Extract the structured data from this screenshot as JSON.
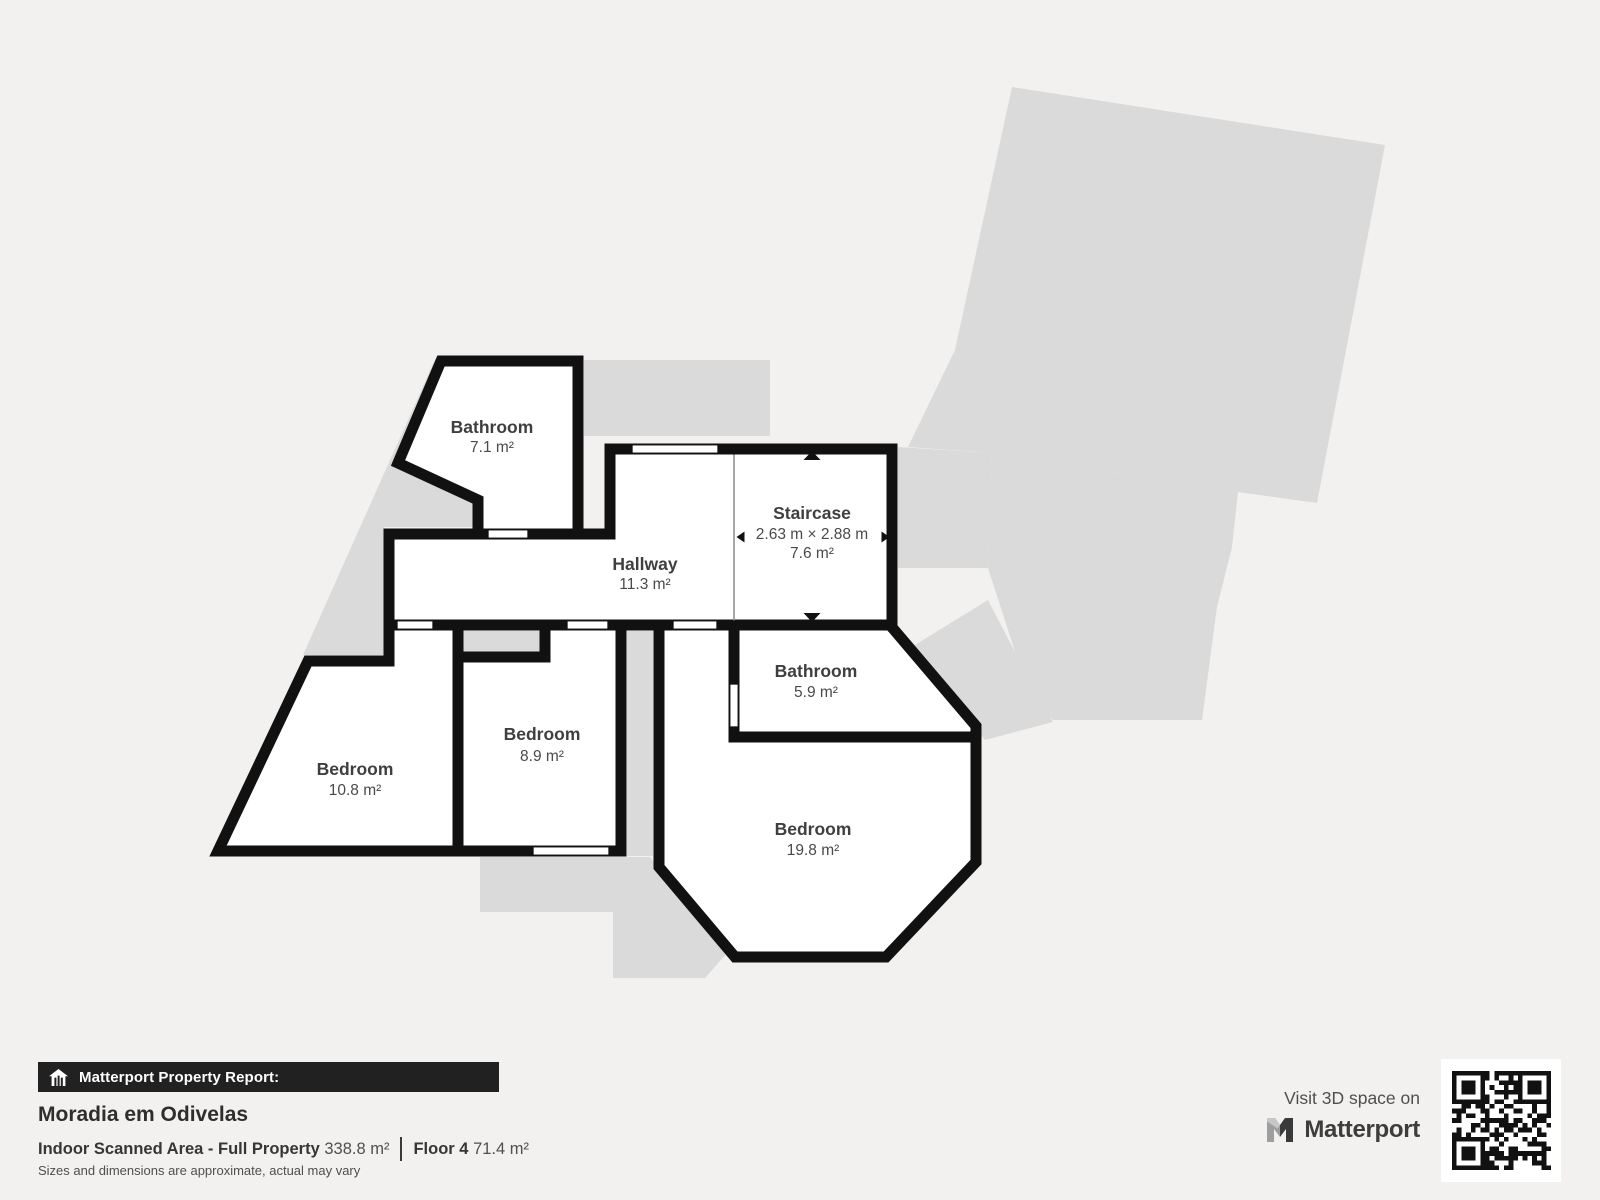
{
  "floorplan": {
    "rooms": [
      {
        "name": "Bathroom",
        "area": "7.1 m²"
      },
      {
        "name": "Hallway",
        "area": "11.3 m²"
      },
      {
        "name": "Staircase",
        "dimensions": "2.63 m × 2.88 m",
        "area": "7.6 m²"
      },
      {
        "name": "Bathroom",
        "area": "5.9 m²"
      },
      {
        "name": "Bedroom",
        "area": "8.9 m²"
      },
      {
        "name": "Bedroom",
        "area": "10.8 m²"
      },
      {
        "name": "Bedroom",
        "area": "19.8 m²"
      }
    ]
  },
  "report": {
    "bar_label": "Matterport Property Report:",
    "title": "Moradia em Odivelas",
    "scanned_area_label": "Indoor Scanned Area - Full Property",
    "scanned_area_value": " 338.8 m²",
    "floor_label": "Floor 4",
    "floor_value": " 71.4 m²",
    "disclaimer": "Sizes and dimensions are approximate, actual may vary"
  },
  "promo": {
    "visit_text": "Visit 3D space on",
    "brand": "Matterport"
  },
  "icons": {
    "house_icon": "house-icon",
    "matterport_logo": "matterport-m-logo",
    "qr_code": "qr-code",
    "stair_arrows": "stair-direction-arrows",
    "dimension_arrows": "dimension-extent-arrows"
  },
  "colors": {
    "page_background": "#f2f1ef",
    "wall": "#111111",
    "room_fill": "#ffffff",
    "ghost_floor": "#dadada",
    "label_text": "#3f3f3f",
    "footer_bar": "#212121"
  }
}
